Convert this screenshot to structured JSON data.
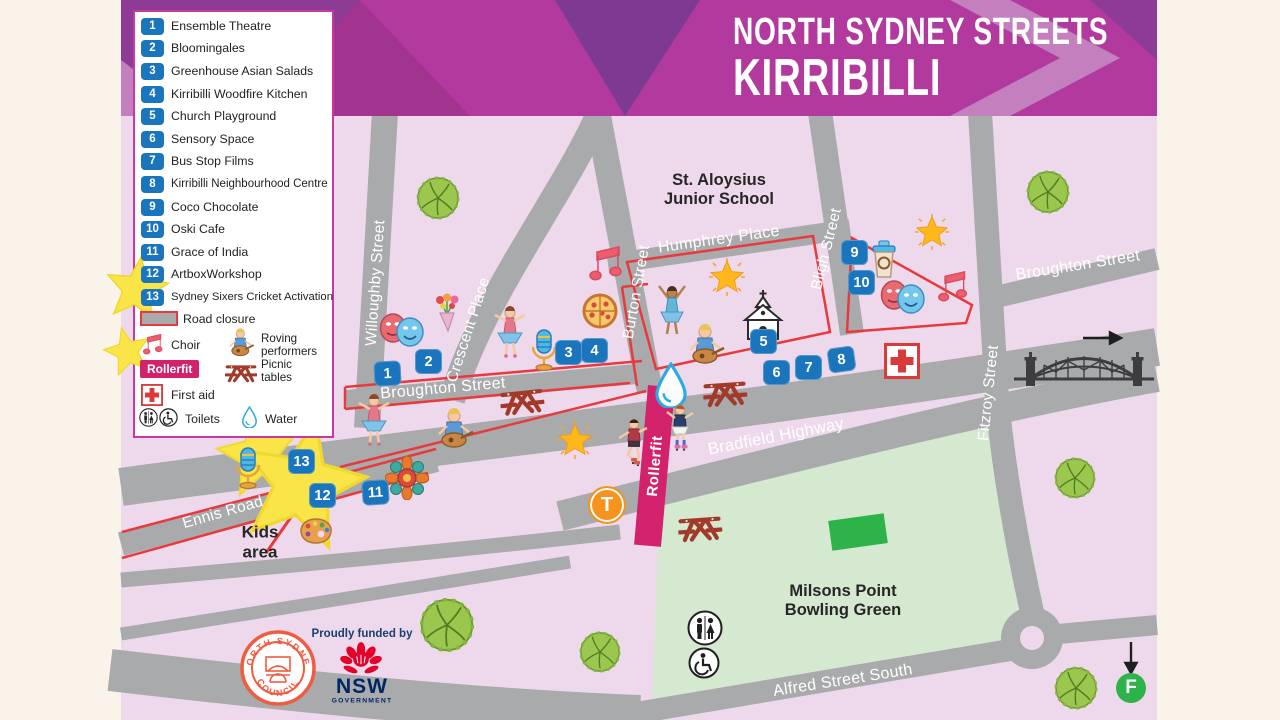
{
  "header": {
    "line1": "NORTH SYDNEY STREETS",
    "line2": "KIRRIBILLI"
  },
  "legend": {
    "items": [
      {
        "num": "1",
        "label": "Ensemble Theatre"
      },
      {
        "num": "2",
        "label": "Bloomingales"
      },
      {
        "num": "3",
        "label": "Greenhouse Asian Salads"
      },
      {
        "num": "4",
        "label": "Kirribilli Woodfire Kitchen"
      },
      {
        "num": "5",
        "label": "Church Playground"
      },
      {
        "num": "6",
        "label": "Sensory Space"
      },
      {
        "num": "7",
        "label": "Bus Stop Films"
      },
      {
        "num": "8",
        "label": "Kirribilli Neighbourhood Centre"
      },
      {
        "num": "9",
        "label": "Coco Chocolate"
      },
      {
        "num": "10",
        "label": "Oski Cafe"
      },
      {
        "num": "11",
        "label": "Grace of India"
      },
      {
        "num": "12",
        "label": "ArtboxWorkshop"
      },
      {
        "num": "13",
        "label": "Sydney Sixers Cricket Activation"
      }
    ],
    "road_closure": "Road closure",
    "choir": "Choir",
    "roving_line1": "Roving",
    "roving_line2": "performers",
    "rollerfit": "Rollerfit",
    "picnic_line1": "Picnic",
    "picnic_line2": "tables",
    "first_aid": "First aid",
    "toilets": "Toilets",
    "water": "Water"
  },
  "map": {
    "streets": {
      "willoughby": "Willoughby Street",
      "crescent": "Crescent Place",
      "burton": "Burton Street",
      "humphrey": "Humphrey Place",
      "bligh": "Bligh Street",
      "fitzroy": "Fitzroy Street",
      "broughton_left": "Broughton Street",
      "broughton_right": "Broughton Street",
      "bradfield": "Bradfield Highway",
      "ennis": "Ennis Road",
      "alfred": "Alfred Street South"
    },
    "places": {
      "school_line1": "St. Aloysius",
      "school_line2": "Junior School",
      "bowling_line1": "Milsons Point",
      "bowling_line2": "Bowling Green",
      "kids_line1": "Kids",
      "kids_line2": "area"
    },
    "rollerfit_label": "Rollerfit",
    "badges": [
      "1",
      "2",
      "3",
      "4",
      "5",
      "6",
      "7",
      "8",
      "9",
      "10",
      "11",
      "12",
      "13"
    ],
    "markers": {
      "train": "T",
      "ferry": "F"
    }
  },
  "footer": {
    "council_top": "NORTH SYDNEY",
    "council_bottom": "COUNCIL",
    "funded": "Proudly funded by",
    "nsw": "NSW",
    "government": "GOVERNMENT"
  },
  "colors": {
    "banner_magenta": "#b23a9e",
    "map_pink": "#eed9ec",
    "road_gray": "#a8aaac",
    "closure_red": "#e8393d",
    "badge_blue": "#1b75bc",
    "rollerfit_pink": "#d2226b",
    "train_orange": "#f6921e",
    "ferry_green": "#2eb34b",
    "bowling_green": "#d5e8d0"
  }
}
